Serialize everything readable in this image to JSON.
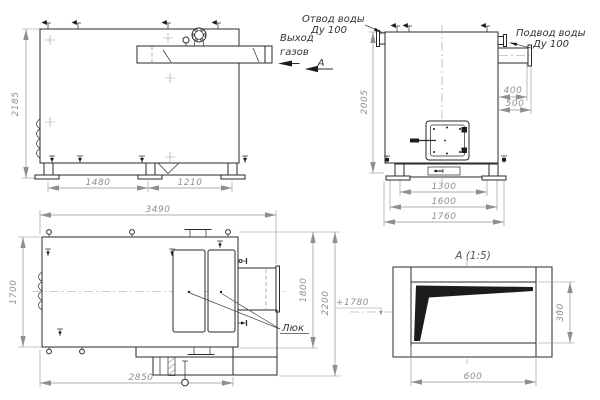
{
  "meta": {
    "drawing_type": "boiler general-arrangement drawing, 4 views",
    "line_color": "#2a2a2a",
    "dim_color": "#909090"
  },
  "views": {
    "side": {
      "dims": {
        "overall_height": "2185",
        "top_pitch": "1705",
        "base_front": "1480",
        "base_rear": "1210"
      },
      "labels": {
        "gas_exit_1": "Выход",
        "gas_exit_2": "газов",
        "section_letter": "А"
      }
    },
    "front": {
      "dims": {
        "overall_height": "2005",
        "inlet_400": "400",
        "inlet_500": "500",
        "base_1300": "1300",
        "base_1600": "1600",
        "base_1760": "1760"
      },
      "labels": {
        "water_outlet_1": "Отвод воды",
        "water_outlet_2": "Ду 100",
        "water_inlet_1": "Подвод воды",
        "water_inlet_2": "Ду 100"
      }
    },
    "top": {
      "dims": {
        "overall_length": "3490",
        "body_width": "1700",
        "width_1800": "1800",
        "width_2200": "2200",
        "length_2850": "2850"
      },
      "labels": {
        "hatch": "Люк"
      }
    },
    "detail": {
      "title": "А (1:5)",
      "dims": {
        "opening_width": "600",
        "opening_height": "300",
        "level_mark": "+1780"
      }
    }
  }
}
